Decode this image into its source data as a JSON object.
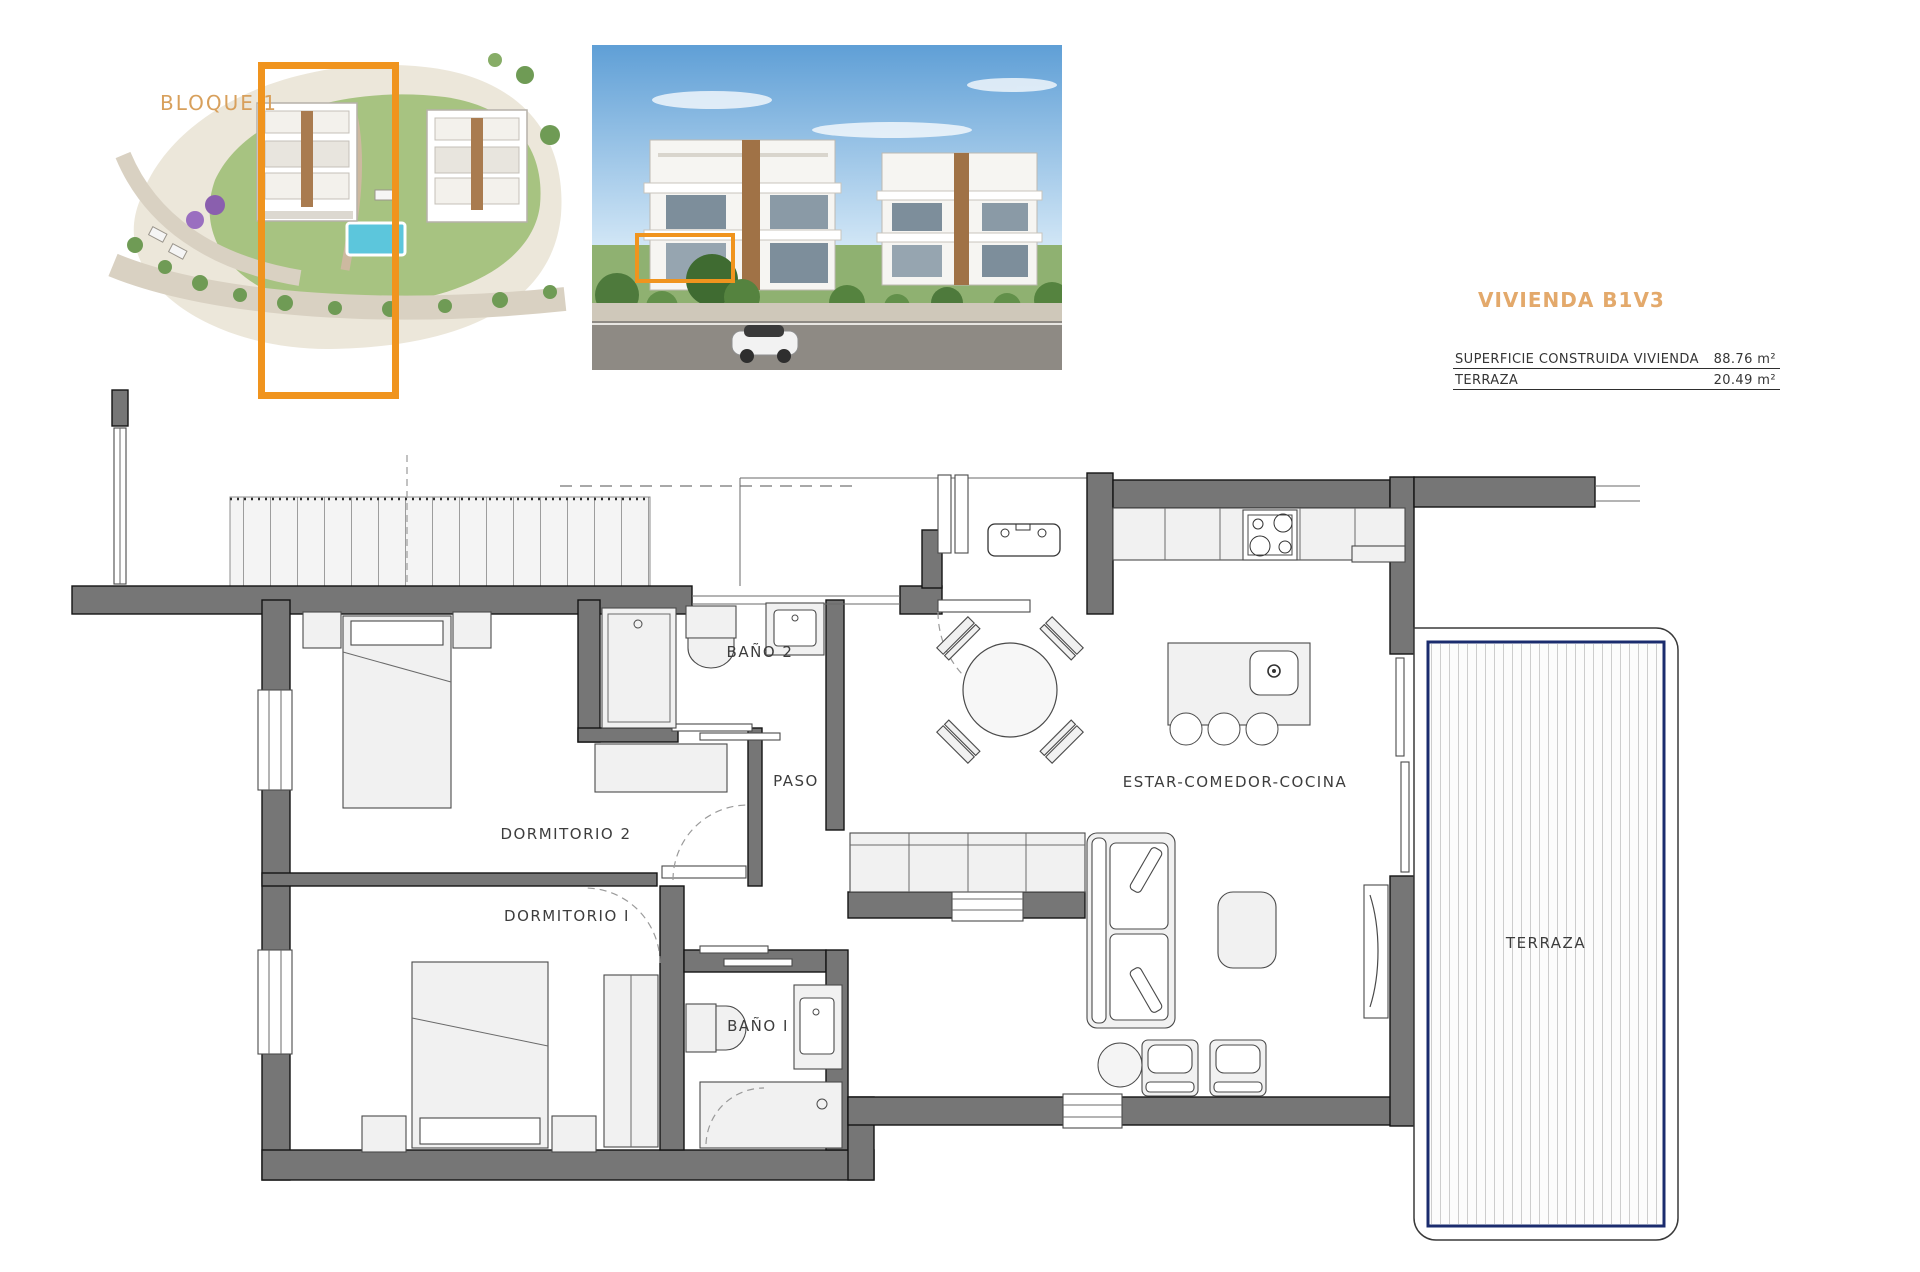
{
  "site_plan": {
    "block_label": "BLOQUE 1",
    "highlight_color": "#F0941E"
  },
  "unit_info": {
    "title": "VIVIENDA B1V3",
    "title_color": "#E3A96B",
    "table": {
      "rows": [
        {
          "label": "SUPERFICIE CONSTRUIDA VIVIENDA",
          "value": "88.76 m²"
        },
        {
          "label": "TERRAZA",
          "value": "20.49 m²"
        }
      ]
    }
  },
  "floor_plan": {
    "rooms": [
      {
        "id": "bano2",
        "label": "BAÑO 2"
      },
      {
        "id": "paso",
        "label": "PASO"
      },
      {
        "id": "dormitorio2",
        "label": "DORMITORIO 2"
      },
      {
        "id": "dormitorio1",
        "label": "DORMITORIO I"
      },
      {
        "id": "bano1",
        "label": "BAÑO I"
      },
      {
        "id": "estar",
        "label": "ESTAR-COMEDOR-COCINA"
      },
      {
        "id": "terraza",
        "label": "TERRAZA"
      }
    ],
    "colors": {
      "wall": "#767676",
      "furniture": "#F1F1F1",
      "terrace_border_navy": "#1B2C6E"
    }
  }
}
